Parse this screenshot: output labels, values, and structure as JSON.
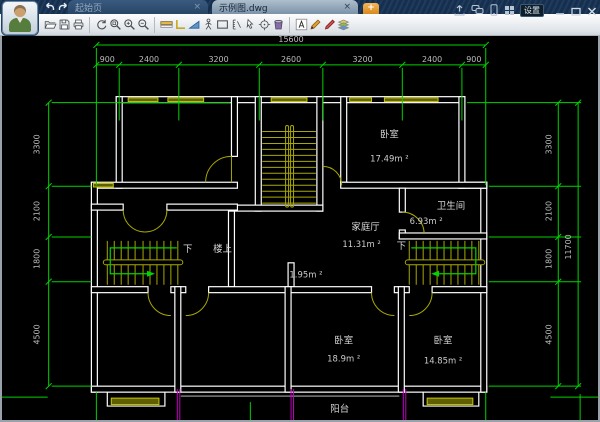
{
  "titlebar": {
    "tabs": [
      {
        "label": "起始页",
        "close": "×"
      },
      {
        "label": "示例图.dwg",
        "close": "×"
      }
    ],
    "new_tab_label": "+",
    "settings_label": "设置",
    "icons": [
      "undo-icon",
      "redo-icon",
      "share-icon",
      "messages-icon",
      "mobile-icon",
      "apps-grid-icon",
      "settings-chip",
      "minimize-icon",
      "maximize-icon",
      "close-icon"
    ]
  },
  "toolbar": {
    "icons": [
      "open-file-icon",
      "save-icon",
      "print-icon",
      "zoom-extents-icon",
      "zoom-window-icon",
      "zoom-in-icon",
      "zoom-out-icon",
      "layer-color-icon",
      "polyline-icon",
      "area-icon",
      "walkthrough-icon",
      "rectangle-icon",
      "measure-icon",
      "select-arrow-icon",
      "center-target-icon",
      "bucket-icon",
      "text-icon",
      "pencil-icon",
      "marker-icon",
      "layers-icon"
    ]
  },
  "drawing": {
    "dimensions": {
      "top_total": "15600",
      "top_segments": [
        "900",
        "2400",
        "3200",
        "2600",
        "3200",
        "2400",
        "900"
      ],
      "left_segments": [
        "3300",
        "2100",
        "1800",
        "4500"
      ],
      "right_segments": [
        "3300",
        "2100",
        "1800",
        "4500"
      ],
      "right_total": "11700"
    },
    "rooms": [
      {
        "name": "卧室",
        "area": "17.49m ²"
      },
      {
        "name": "家庭厅",
        "area": "11.31m ²"
      },
      {
        "name": "卫生间",
        "area": "6.93m ²"
      },
      {
        "name": "卧室",
        "area": "18.9m ²"
      },
      {
        "name": "卧室",
        "area": "14.85m ²"
      }
    ],
    "labels": {
      "down_left": "下",
      "upstairs": "楼上",
      "down_right": "下",
      "small_area": "1.95m ²",
      "balcony": "阳台"
    },
    "colors": {
      "dimension": "#00d400",
      "wall": "#ffffff",
      "fixture": "#a8a800",
      "balcony_rail": "#c000c0",
      "balcony_edge": "#7a7a7a",
      "text": "#cfcfcf",
      "background": "#000000"
    }
  }
}
